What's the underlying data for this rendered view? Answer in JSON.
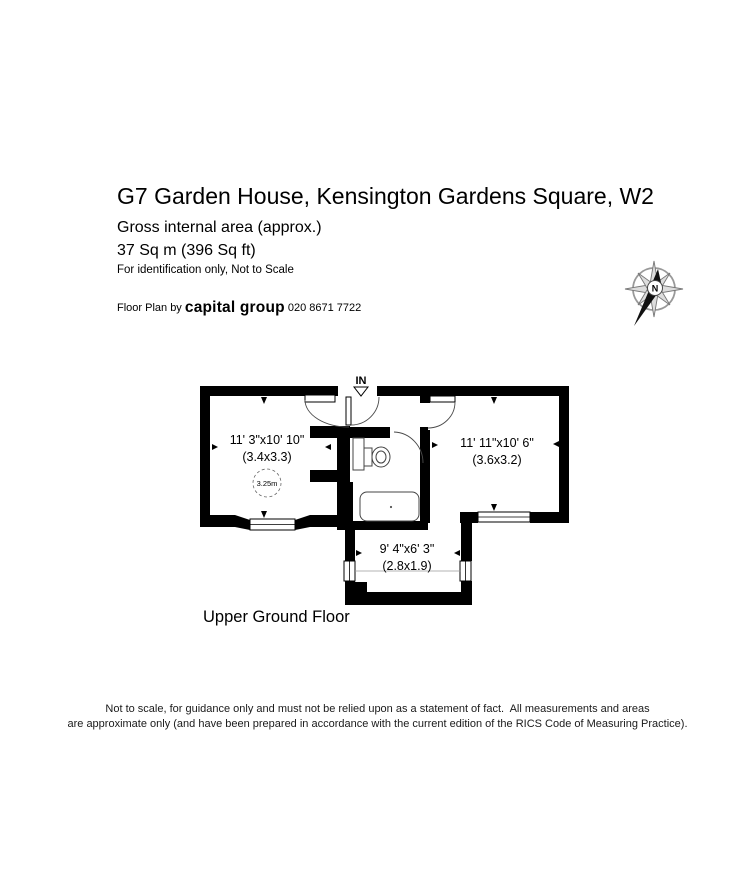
{
  "header": {
    "title": "G7 Garden House, Kensington Gardens Square, W2",
    "area_note": "Gross internal area (approx.)",
    "area_value": "37 Sq m (396 Sq ft)",
    "identification_note": "For identification only, Not to Scale",
    "credit_prefix": "Floor Plan by ",
    "credit_brand": "capital group",
    "credit_phone": " 020 8671 7722"
  },
  "compass": {
    "north_label": "N"
  },
  "plan": {
    "entrance_label": "IN",
    "floor_label": "Upper Ground Floor",
    "rooms": [
      {
        "name": "left-room",
        "dims_ft": "11' 3\"x10' 10\"",
        "dims_m": "(3.4x3.3)",
        "ceiling_height": "3.25m"
      },
      {
        "name": "right-room",
        "dims_ft": "11' 11\"x10' 6\"",
        "dims_m": "(3.6x3.2)"
      },
      {
        "name": "bottom-room",
        "dims_ft": "9' 4\"x6' 3\"",
        "dims_m": "(2.8x1.9)"
      }
    ]
  },
  "footer": {
    "disclaimer_line1": "Not to scale, for guidance only and must not be relied upon as a statement of fact.  All measurements and areas",
    "disclaimer_line2": "are approximate only (and have been prepared in accordance with the current edition of the RICS Code of Measuring Practice)."
  },
  "colors": {
    "wall": "#000000",
    "background": "#ffffff",
    "compass_gray": "#999999"
  }
}
